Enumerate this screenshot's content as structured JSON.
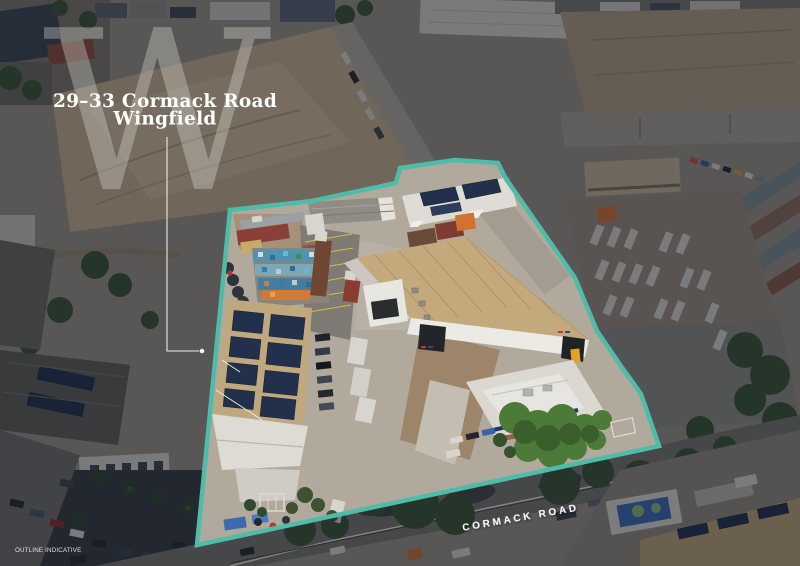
{
  "watermark": {
    "letter": "W"
  },
  "title": {
    "line1": "29–33 Cormack Road",
    "line2": "Wingfield"
  },
  "road": {
    "label": "CORMACK ROAD"
  },
  "footnote": {
    "text": "OUTLINE INDICATIVE"
  },
  "colors": {
    "outline": "#4fbcaa",
    "watermark": "rgba(232,227,219,0.33)",
    "title": "#fdfdfb",
    "road_label": "#ffffff",
    "footnote": "#e2e2df",
    "dim_overlay": "rgba(15,21,33,0.47)"
  }
}
